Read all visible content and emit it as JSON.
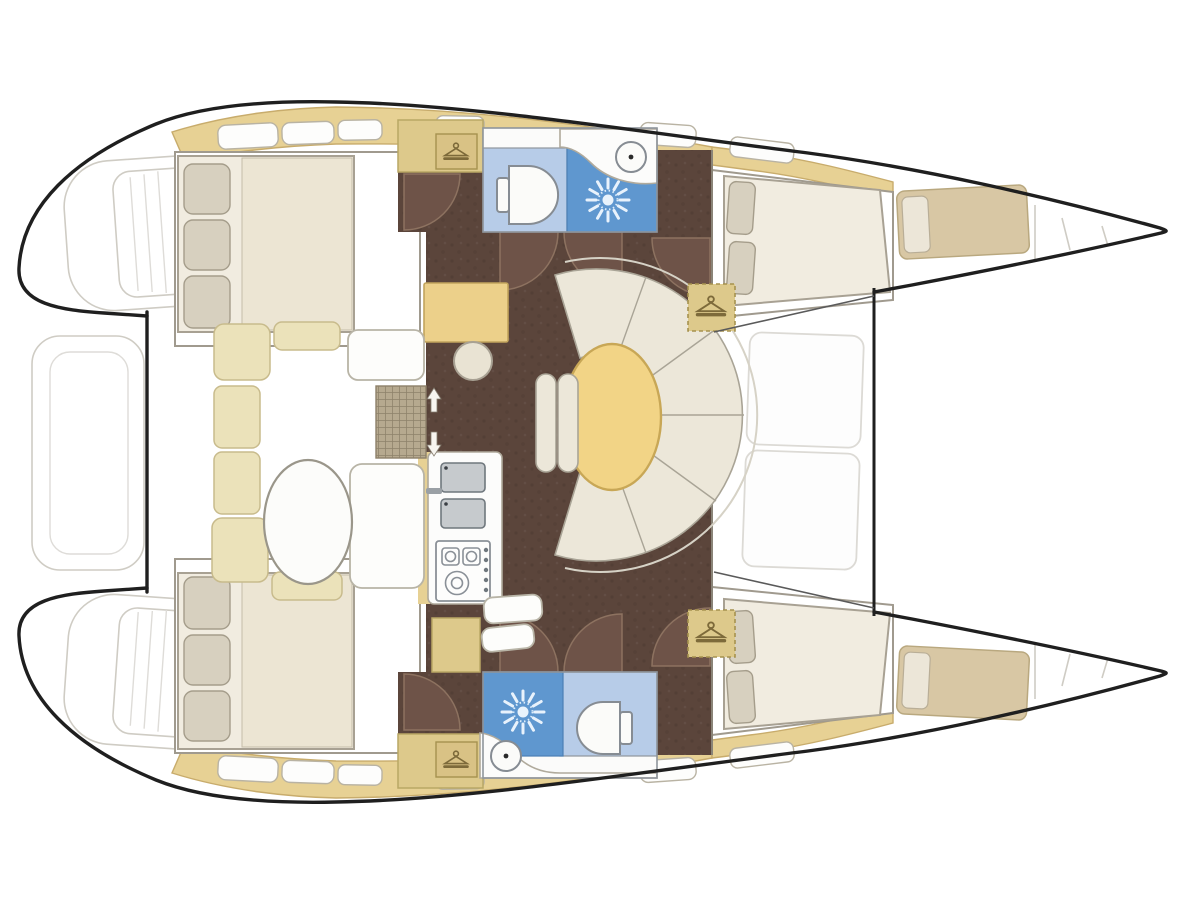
{
  "meta": {
    "title": "Catamaran layout floor plan",
    "type": "boat-floor-plan",
    "orientation": "top view, bow pointing right, twin hulls with centre bridgedeck",
    "visible_text": ""
  },
  "colors": {
    "white": "#ffffff",
    "hull_outline": "#1f1f1f",
    "wall_gray": "#a09a8e",
    "faint_line": "#cfccc4",
    "deck_tan": "#e7d194",
    "deck_tan_border": "#c8ac6c",
    "closet_tan": "#ddc98b",
    "berth_tan": "#d8c7a4",
    "floor_brown": "#5b453b",
    "door_brown": "#6e5348",
    "arc_stroke": "#8d7260",
    "bath_blue": "#b7cce8",
    "shower_blue": "#5f97cf",
    "cushion_cream": "#ece7d9",
    "cushion_border": "#a9a496",
    "settee_yellow": "#ebe2ba",
    "settee_border": "#c8bb8c",
    "bed_cream": "#ece5d3",
    "bed_border": "#a8a193",
    "pillow_beige": "#d7d0bf",
    "table_yellow": "#f2d486",
    "table_border": "#c8a756",
    "appliance_gray": "#c6cacd",
    "appliance_border": "#6f777d",
    "icon_brown": "#7d6a3a"
  },
  "rooms": {
    "cockpit": "Aft cockpit with U-shaped settee and oval table",
    "saloon": "Saloon with oval dining table, curved settee, chart desk and stool",
    "galley": "Galley with double sink and two-burner stove",
    "head_top": "Head with toilet, wash basin and shower",
    "head_bottom": "Head with shower, toilet and wash basin",
    "aft_cabin_top": "Aft double cabin",
    "aft_cabin_bottom": "Aft double cabin",
    "forward_cabin_top": "Forward double cabin",
    "forward_cabin_bottom": "Forward double cabin",
    "forepeak_top": "Forepeak single berth",
    "forepeak_bottom": "Forepeak single berth",
    "foredeck": "Foredeck door area between hulls",
    "transoms": "Twin transom boarding steps"
  },
  "icons": {
    "hanger": "wardrobe hanger icon",
    "shower_rose": "shower rose sunburst icon",
    "steps_arrows": "companionway up-down arrows",
    "grate": "companionway grating"
  }
}
